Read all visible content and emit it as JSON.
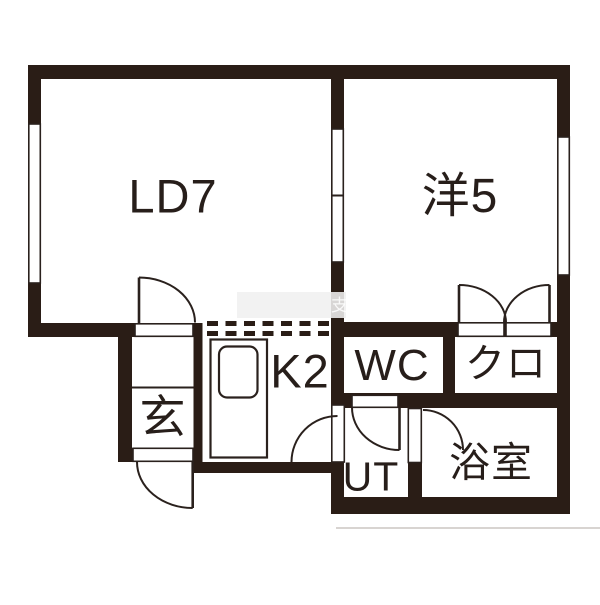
{
  "title": "apartment-floor-plan",
  "colors": {
    "wall": "#2a1d16",
    "line": "#2a211d",
    "text": "#271e1a",
    "wmband": "rgba(240,240,240,0.88)",
    "wmtext": "rgba(255,255,255,0.85)"
  },
  "rooms": {
    "living_dining": {
      "label": "LD7"
    },
    "western_room": {
      "label": "洋5"
    },
    "kitchen": {
      "label": "K2"
    },
    "toilet": {
      "label": "WC"
    },
    "closet": {
      "label": "クロ"
    },
    "entrance": {
      "label": "玄"
    },
    "utility": {
      "label": "UT"
    },
    "bathroom": {
      "label": "浴室"
    }
  },
  "watermark": {
    "text": "支"
  }
}
